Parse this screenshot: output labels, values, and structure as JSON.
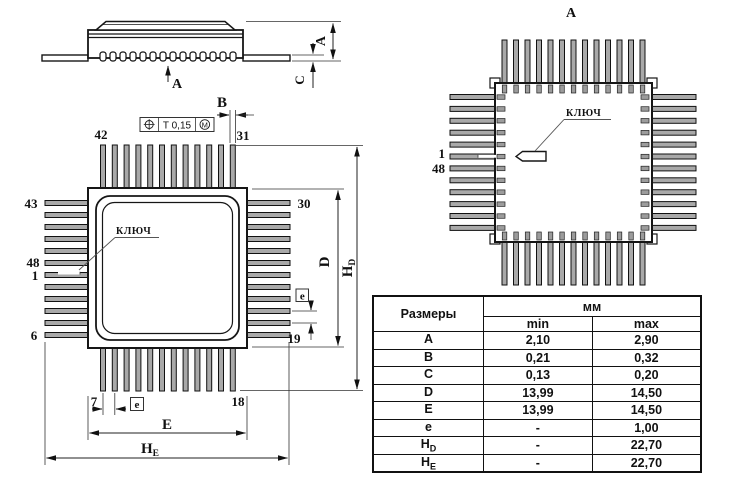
{
  "side_view": {
    "view_arrow_label": "A",
    "dim_height": "A",
    "dim_lead": "C"
  },
  "tolerance_frame": {
    "value": "T 0,15",
    "modifier": "M"
  },
  "front_view": {
    "key_label": "КЛЮЧ",
    "dim_b": "B",
    "dim_d": "D",
    "dim_body_e": "E",
    "pitch_label_bottom": "e",
    "pitch_label_right": "e",
    "dim_hd": {
      "base": "H",
      "sub": "D"
    },
    "dim_he": {
      "base": "H",
      "sub": "E"
    },
    "pins": {
      "p42": "42",
      "p31": "31",
      "p43": "43",
      "p30": "30",
      "p48": "48",
      "p1": "1",
      "p6": "6",
      "p7": "7",
      "p18": "18",
      "p19": "19"
    }
  },
  "bottom_view": {
    "view_label": "A",
    "key_label": "КЛЮЧ",
    "pin1": "1",
    "pin48": "48"
  },
  "table": {
    "header_dims": "Размеры",
    "header_unit": "мм",
    "header_min": "min",
    "header_max": "max",
    "rows": [
      {
        "base": "A",
        "sub": "",
        "min": "2,10",
        "max": "2,90"
      },
      {
        "base": "B",
        "sub": "",
        "min": "0,21",
        "max": "0,32"
      },
      {
        "base": "C",
        "sub": "",
        "min": "0,13",
        "max": "0,20"
      },
      {
        "base": "D",
        "sub": "",
        "min": "13,99",
        "max": "14,50"
      },
      {
        "base": "E",
        "sub": "",
        "min": "13,99",
        "max": "14,50"
      },
      {
        "base": "e",
        "sub": "",
        "min": "-",
        "max": "1,00"
      },
      {
        "base": "H",
        "sub": "D",
        "min": "-",
        "max": "22,70"
      },
      {
        "base": "H",
        "sub": "E",
        "min": "-",
        "max": "22,70"
      }
    ]
  }
}
